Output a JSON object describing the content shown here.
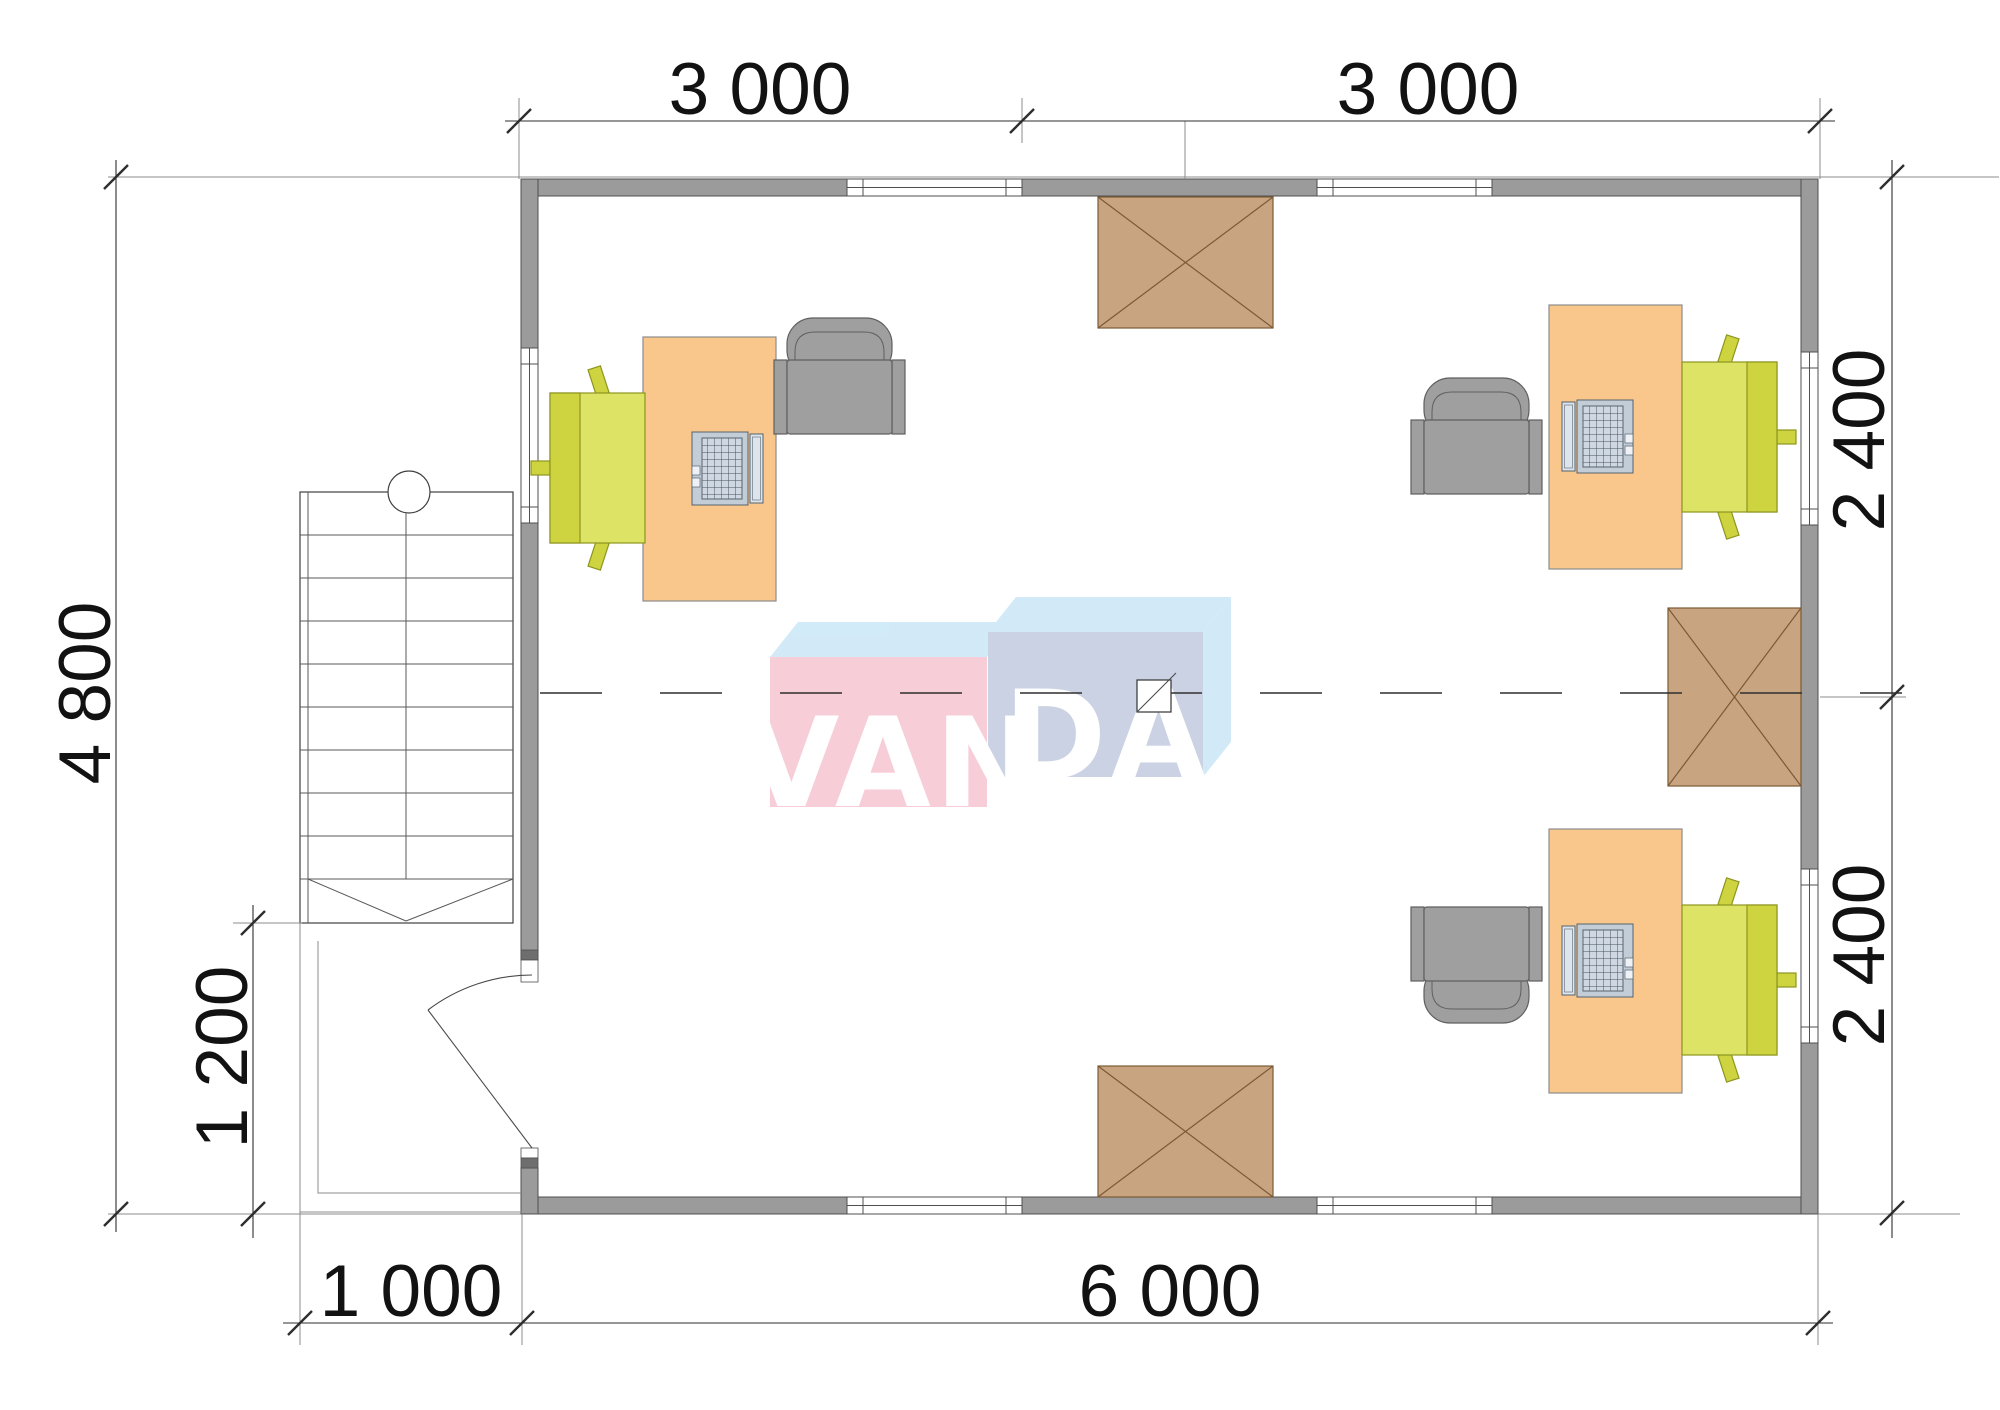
{
  "drawing": {
    "dims": {
      "top_left": "3 000",
      "top_right": "3 000",
      "left": "4 800",
      "right_upper": "2 400",
      "right_lower": "2 400",
      "porch_depth": "1 200",
      "bottom_left": "1 000",
      "bottom_right": "6 000"
    },
    "watermark": {
      "left": "VAN",
      "right": "DA"
    }
  },
  "colors": {
    "wall": "#9b9b9b",
    "wall_line": "#4f4f4f",
    "dim": "#2e2e2e",
    "line_thin": "#8c8c8c",
    "stairs_line": "#3f3f3f",
    "centerline": "#2f2f2f",
    "desk": "#f9c78c",
    "desk_line": "#8d8d8d",
    "chair_gray": "#9f9f9f",
    "chair_gray_line": "#5f5f5f",
    "green": "#dde364",
    "green_dark": "#cdd43f",
    "green_line": "#8e951f",
    "brown": "#c8a480",
    "brown_line": "#7c5a35",
    "laptop": "#c3cdd7",
    "laptop_screen": "#dde4eb",
    "laptop_line": "#55626e",
    "logo_pink": "#f7cbd4",
    "logo_blue": "#cfe9f8",
    "logo_gray": "#c6cfe2",
    "logo_text": "#ffffff"
  }
}
